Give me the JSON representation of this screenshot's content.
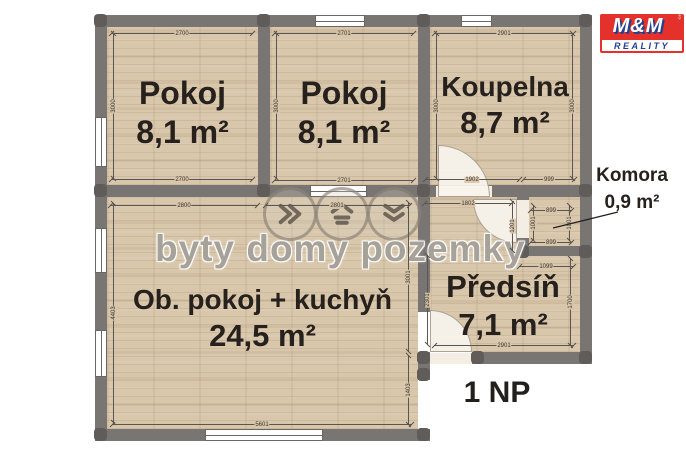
{
  "watermark": {
    "text": "byty domy pozemky"
  },
  "logo": {
    "top": "M&M",
    "bottom": "REALITY",
    "side": "HOLDING"
  },
  "floor_label": "1 NP",
  "rooms": {
    "pokoj1": {
      "name": "Pokoj",
      "area": "8,1 m²"
    },
    "pokoj2": {
      "name": "Pokoj",
      "area": "8,1 m²"
    },
    "koupelna": {
      "name": "Koupelna",
      "area": "8,7 m²"
    },
    "obyvaci": {
      "name": "Ob. pokoj + kuchyň",
      "area": "24,5 m²"
    },
    "predsin": {
      "name": "Předsíň",
      "area": "7,1 m²"
    },
    "komora": {
      "name": "Komora",
      "area": "0,9 m²"
    }
  },
  "colors": {
    "wall": "#797572",
    "floor": "#d9c7ab",
    "logo_red": "#e4312b",
    "logo_blue": "#23418e"
  },
  "dimensions": [
    {
      "t": "2700",
      "x": 182,
      "y": 33,
      "l": 142,
      "o": "h"
    },
    {
      "t": "3000",
      "x": 113,
      "y": 106,
      "l": 146,
      "o": "v"
    },
    {
      "t": "2700",
      "x": 182,
      "y": 179,
      "l": 142,
      "o": "h"
    },
    {
      "t": "2701",
      "x": 344,
      "y": 33,
      "l": 140,
      "o": "h"
    },
    {
      "t": "3000",
      "x": 276,
      "y": 106,
      "l": 146,
      "o": "v"
    },
    {
      "t": "2701",
      "x": 344,
      "y": 180,
      "l": 140,
      "o": "h"
    },
    {
      "t": "2901",
      "x": 504,
      "y": 33,
      "l": 140,
      "o": "h"
    },
    {
      "t": "3000",
      "x": 436,
      "y": 106,
      "l": 146,
      "o": "v"
    },
    {
      "t": "3000",
      "x": 572,
      "y": 106,
      "l": 146,
      "o": "v"
    },
    {
      "t": "1902",
      "x": 472,
      "y": 179,
      "l": 95,
      "o": "h"
    },
    {
      "t": "999",
      "x": 549,
      "y": 179,
      "l": 52,
      "o": "h"
    },
    {
      "t": "1802",
      "x": 468,
      "y": 203,
      "l": 88,
      "o": "h"
    },
    {
      "t": "1201",
      "x": 512,
      "y": 226,
      "l": 50,
      "o": "v"
    },
    {
      "t": "899",
      "x": 551,
      "y": 210,
      "l": 42,
      "o": "h"
    },
    {
      "t": "1001",
      "x": 533,
      "y": 223,
      "l": 36,
      "o": "v"
    },
    {
      "t": "1001",
      "x": 569,
      "y": 223,
      "l": 36,
      "o": "v"
    },
    {
      "t": "899",
      "x": 551,
      "y": 242,
      "l": 42,
      "o": "h"
    },
    {
      "t": "1099",
      "x": 546,
      "y": 266,
      "l": 55,
      "o": "h"
    },
    {
      "t": "2301",
      "x": 427,
      "y": 300,
      "l": 90,
      "o": "v"
    },
    {
      "t": "1700",
      "x": 570,
      "y": 302,
      "l": 88,
      "o": "v"
    },
    {
      "t": "2901",
      "x": 504,
      "y": 345,
      "l": 140,
      "o": "h"
    },
    {
      "t": "2800",
      "x": 184,
      "y": 205,
      "l": 148,
      "o": "h"
    },
    {
      "t": "2801",
      "x": 337,
      "y": 205,
      "l": 145,
      "o": "h"
    },
    {
      "t": "4403",
      "x": 113,
      "y": 313,
      "l": 220,
      "o": "v"
    },
    {
      "t": "3001",
      "x": 408,
      "y": 277,
      "l": 150,
      "o": "v"
    },
    {
      "t": "1403",
      "x": 408,
      "y": 390,
      "l": 70,
      "o": "v"
    },
    {
      "t": "5601",
      "x": 262,
      "y": 424,
      "l": 300,
      "o": "h"
    }
  ]
}
